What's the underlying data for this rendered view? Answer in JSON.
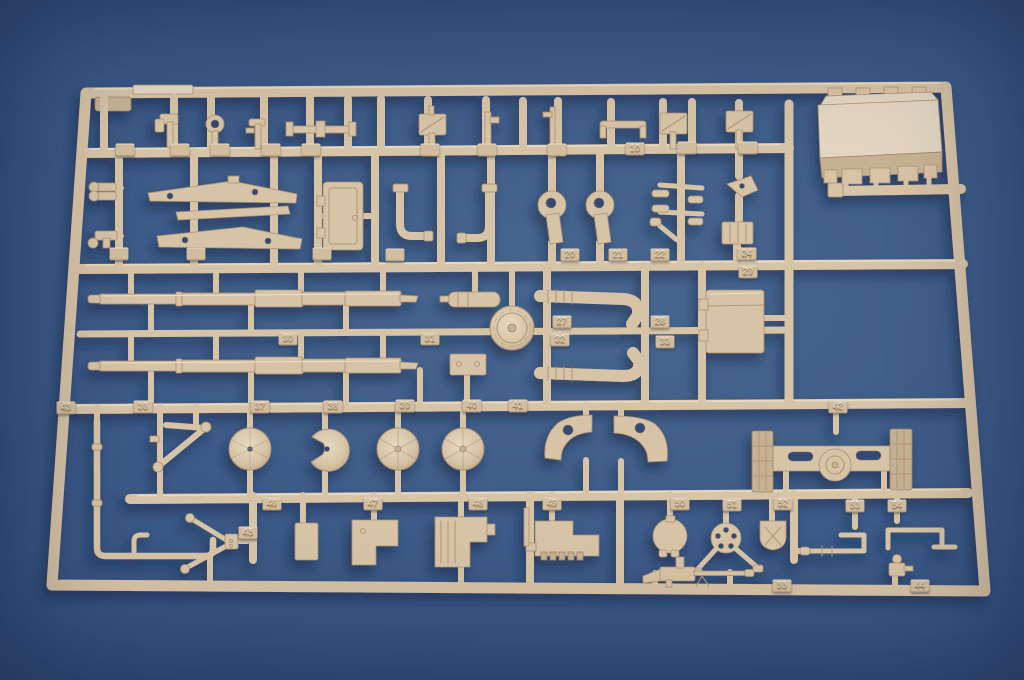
{
  "scene": {
    "type": "photograph",
    "subject": "Tan injection-molded plastic model kit sprue (parts tree) lying on a blue backdrop",
    "colors": {
      "background_center": "#48678f",
      "background_edge": "#2b426a",
      "plastic": "#d7c3a5",
      "plastic_highlight": "#ece1cb",
      "plastic_shadow": "#ad9274"
    }
  },
  "sprue": {
    "legible_part_numbers": [
      "10",
      "20",
      "21",
      "22",
      "24",
      "27",
      "28",
      "29",
      "30",
      "31",
      "32",
      "33",
      "36",
      "37",
      "38",
      "39",
      "40",
      "41",
      "42",
      "43",
      "44",
      "45",
      "46",
      "47",
      "48",
      "49",
      "50",
      "51",
      "52",
      "53",
      "54",
      "55"
    ],
    "part_number_tabs": [
      {
        "label": "",
        "x": 125,
        "y": 150
      },
      {
        "label": "",
        "x": 180,
        "y": 150
      },
      {
        "label": "",
        "x": 220,
        "y": 150
      },
      {
        "label": "",
        "x": 271,
        "y": 150
      },
      {
        "label": "",
        "x": 311,
        "y": 150
      },
      {
        "label": "",
        "x": 430,
        "y": 150
      },
      {
        "label": "",
        "x": 487,
        "y": 150
      },
      {
        "label": "",
        "x": 557,
        "y": 150
      },
      {
        "label": "10",
        "x": 635,
        "y": 149
      },
      {
        "label": "",
        "x": 687,
        "y": 148
      },
      {
        "label": "",
        "x": 748,
        "y": 148
      },
      {
        "label": "",
        "x": 119,
        "y": 254
      },
      {
        "label": "",
        "x": 196,
        "y": 254
      },
      {
        "label": "",
        "x": 322,
        "y": 254
      },
      {
        "label": "",
        "x": 395,
        "y": 255
      },
      {
        "label": "20",
        "x": 570,
        "y": 255
      },
      {
        "label": "21",
        "x": 618,
        "y": 255
      },
      {
        "label": "22",
        "x": 660,
        "y": 255
      },
      {
        "label": "24",
        "x": 747,
        "y": 254
      },
      {
        "label": "29",
        "x": 748,
        "y": 272
      },
      {
        "label": "27",
        "x": 562,
        "y": 322
      },
      {
        "label": "28",
        "x": 660,
        "y": 322
      },
      {
        "label": "30",
        "x": 288,
        "y": 339
      },
      {
        "label": "31",
        "x": 430,
        "y": 339
      },
      {
        "label": "32",
        "x": 560,
        "y": 340
      },
      {
        "label": "33",
        "x": 665,
        "y": 342
      },
      {
        "label": "43",
        "x": 66,
        "y": 408
      },
      {
        "label": "36",
        "x": 143,
        "y": 407
      },
      {
        "label": "37",
        "x": 260,
        "y": 407
      },
      {
        "label": "38",
        "x": 333,
        "y": 407
      },
      {
        "label": "39",
        "x": 405,
        "y": 406
      },
      {
        "label": "40",
        "x": 472,
        "y": 406
      },
      {
        "label": "41",
        "x": 518,
        "y": 406
      },
      {
        "label": "42",
        "x": 838,
        "y": 407
      },
      {
        "label": "45",
        "x": 248,
        "y": 533
      },
      {
        "label": "46",
        "x": 272,
        "y": 504
      },
      {
        "label": "47",
        "x": 373,
        "y": 504
      },
      {
        "label": "48",
        "x": 478,
        "y": 504
      },
      {
        "label": "49",
        "x": 552,
        "y": 504
      },
      {
        "label": "50",
        "x": 680,
        "y": 504
      },
      {
        "label": "51",
        "x": 732,
        "y": 505
      },
      {
        "label": "52",
        "x": 783,
        "y": 504
      },
      {
        "label": "53",
        "x": 855,
        "y": 506
      },
      {
        "label": "54",
        "x": 897,
        "y": 506
      },
      {
        "label": "55",
        "x": 782,
        "y": 586
      },
      {
        "label": "44",
        "x": 920,
        "y": 586
      }
    ]
  }
}
